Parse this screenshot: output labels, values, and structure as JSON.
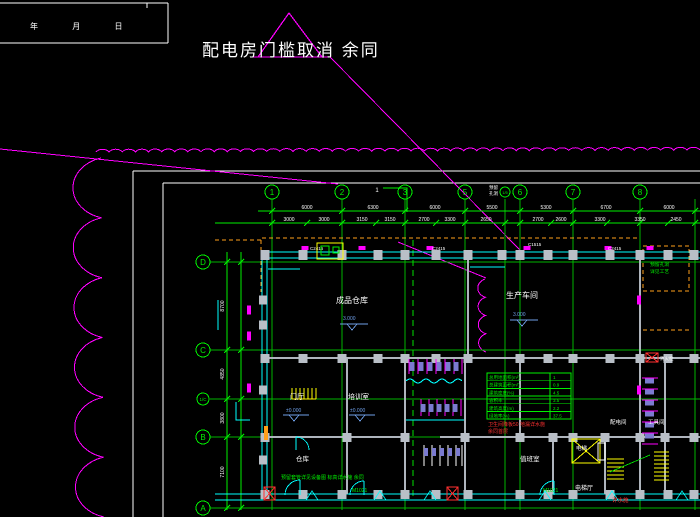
{
  "annotation": {
    "text": "配电房门槛取消 余同"
  },
  "title_block": {
    "date_header": "年 月 日"
  },
  "grid": {
    "top_labels": [
      "1",
      "2",
      "3",
      "5",
      "6",
      "7",
      "8"
    ],
    "top_sub": "1/5",
    "left_labels": [
      "D",
      "C",
      "1/C",
      "B",
      "A"
    ],
    "axis_tag": "1"
  },
  "dimensions": {
    "top1": [
      "6000",
      "6300",
      "6000",
      "5500",
      "5300",
      "6700",
      "6000"
    ],
    "top2": [
      "3000",
      "3000",
      "3150",
      "3150",
      "2700",
      "3300",
      "2650",
      "2700",
      "2600",
      "3300",
      "3350",
      "2450"
    ],
    "left": [
      "8700",
      "4850",
      "3800",
      "7100"
    ]
  },
  "codes": {
    "windows": [
      "C2415",
      "C2415",
      "C1515",
      "C2415"
    ],
    "doors": [
      "M1021",
      "M1021"
    ],
    "hydrant": "消火栓"
  },
  "rooms": {
    "hall_left": {
      "name": "成品仓库",
      "elev": "3.000"
    },
    "hall_right": {
      "name": "生产车间",
      "elev": "3.000"
    },
    "lobby": {
      "name": "门厅",
      "elev": "±0.000"
    },
    "training": {
      "name": "培训室",
      "elev": "±0.000"
    },
    "storage": {
      "name": "仓库"
    },
    "duty": {
      "name": "值班室"
    },
    "power": {
      "name": "配电间"
    },
    "tool": {
      "name": "工具间"
    },
    "elevator": {
      "name": "电梯"
    },
    "elev_hall": {
      "name": "电梯厅"
    }
  },
  "indicator_table": {
    "rows": [
      {
        "label": "总用地面积(m²)",
        "value": "1"
      },
      {
        "label": "总建筑面积(m²)",
        "value": "0.9"
      },
      {
        "label": "建筑密度(%)",
        "value": "4.5"
      },
      {
        "label": "容积率",
        "value": "3.5"
      },
      {
        "label": "建筑高度(m)",
        "value": "2.2"
      },
      {
        "label": "绿地率(%)",
        "value": "37.5"
      }
    ],
    "red_note1": "卫生间降板50 地漏详水施",
    "red_note2": "余同首层"
  },
  "notes": {
    "process_line1": "预留孔洞",
    "process_line2": "详见工艺",
    "sub_line1": "预留",
    "sub_line2": "孔洞",
    "bottom": "预留套管详见设备图 标高详水施 余同",
    "red_tag": "详水施"
  },
  "colors": {
    "background": "#000000",
    "green": "#00f000",
    "cyan": "#00ffff",
    "magenta": "#ff00ff",
    "yellow": "#ffff00",
    "orange": "#ff9f1a",
    "white": "#ffffff",
    "gray_column": "#b9bfc7",
    "fixture": "#7b7bd0",
    "elev_blue": "#6f9fe8",
    "red": "#ff3030"
  }
}
